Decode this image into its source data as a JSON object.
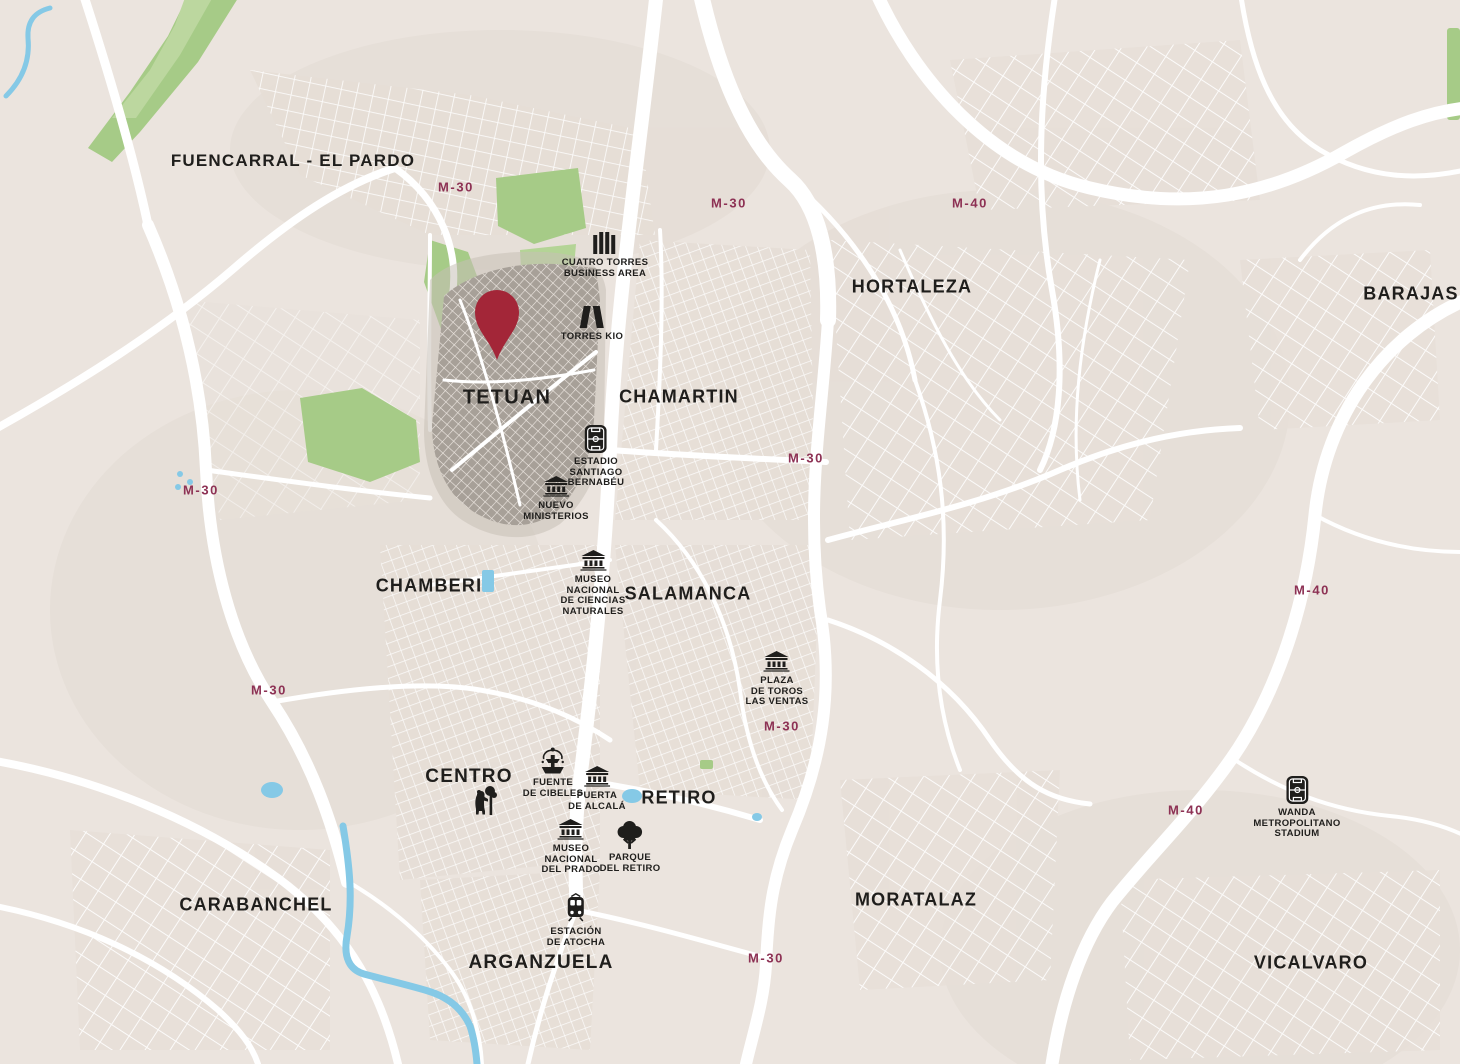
{
  "map": {
    "colors": {
      "background": "#ebe4de",
      "road": "#ffffff",
      "park": "#a6cb87",
      "park_light": "#bcd79f",
      "water": "#85c9e6",
      "district_highlight": "#a7a098",
      "pin": "#a32638",
      "road_label": "#8d3154",
      "label_text": "#1f1e1c"
    },
    "pin": {
      "x": 497,
      "y": 360
    },
    "district_labels": [
      {
        "label": "FUENCARRAL - EL PARDO",
        "x": 293,
        "y": 161,
        "size": 17
      },
      {
        "label": "HORTALEZA",
        "x": 912,
        "y": 287,
        "size": 18
      },
      {
        "label": "BARAJAS",
        "x": 1411,
        "y": 294,
        "size": 18
      },
      {
        "label": "TETUAN",
        "x": 507,
        "y": 398,
        "size": 20
      },
      {
        "label": "CHAMARTIN",
        "x": 679,
        "y": 397,
        "size": 18
      },
      {
        "label": "CHAMBERI",
        "x": 429,
        "y": 586,
        "size": 18
      },
      {
        "label": "SALAMANCA",
        "x": 688,
        "y": 594,
        "size": 18
      },
      {
        "label": "CENTRO",
        "x": 469,
        "y": 777,
        "size": 19
      },
      {
        "label": "RETIRO",
        "x": 679,
        "y": 798,
        "size": 18
      },
      {
        "label": "CARABANCHEL",
        "x": 256,
        "y": 905,
        "size": 18
      },
      {
        "label": "MORATALAZ",
        "x": 916,
        "y": 900,
        "size": 18
      },
      {
        "label": "ARGANZUELA",
        "x": 541,
        "y": 963,
        "size": 19
      },
      {
        "label": "VICALVARO",
        "x": 1311,
        "y": 963,
        "size": 18
      }
    ],
    "road_labels": [
      {
        "label": "M-30",
        "x": 456,
        "y": 187
      },
      {
        "label": "M-30",
        "x": 729,
        "y": 203
      },
      {
        "label": "M-40",
        "x": 970,
        "y": 203
      },
      {
        "label": "M-30",
        "x": 201,
        "y": 490
      },
      {
        "label": "M-30",
        "x": 806,
        "y": 458
      },
      {
        "label": "M-40",
        "x": 1312,
        "y": 590
      },
      {
        "label": "M-30",
        "x": 269,
        "y": 690
      },
      {
        "label": "M-30",
        "x": 782,
        "y": 726
      },
      {
        "label": "M-40",
        "x": 1186,
        "y": 810
      },
      {
        "label": "M-30",
        "x": 766,
        "y": 958
      }
    ],
    "landmarks": [
      {
        "name": "cuatro-torres-business-area",
        "icon": "four-towers-icon",
        "x": 605,
        "y": 232,
        "lines": [
          "CUATRO TORRES",
          "BUSINESS AREA"
        ]
      },
      {
        "name": "torres-kio",
        "icon": "kio-towers-icon",
        "x": 592,
        "y": 306,
        "lines": [
          "TORRES KIO"
        ]
      },
      {
        "name": "estadio-santiago-bernabeu",
        "icon": "stadium-icon",
        "x": 596,
        "y": 425,
        "lines": [
          "ESTADIO",
          "SANTIAGO",
          "BERNABÉU"
        ]
      },
      {
        "name": "nuevo-ministerios",
        "icon": "museum-icon",
        "x": 556,
        "y": 476,
        "lines": [
          "NUEVO",
          "MINISTERIOS"
        ]
      },
      {
        "name": "museo-nacional-de-ciencias-naturales",
        "icon": "museum-icon",
        "x": 593,
        "y": 550,
        "lines": [
          "MUSEO",
          "NACIONAL",
          "DE CIENCIAS",
          "NATURALES"
        ]
      },
      {
        "name": "plaza-de-toros-las-ventas",
        "icon": "museum-icon",
        "x": 777,
        "y": 651,
        "lines": [
          "PLAZA",
          "DE TOROS",
          "LAS VENTAS"
        ]
      },
      {
        "name": "fuente-de-cibeles",
        "icon": "fountain-icon",
        "x": 553,
        "y": 747,
        "lines": [
          "FUENTE",
          "DE CIBELES"
        ]
      },
      {
        "name": "puerta-de-alcala",
        "icon": "museum-icon",
        "x": 597,
        "y": 766,
        "lines": [
          "PUERTA",
          "DE ALCALÁ"
        ]
      },
      {
        "name": "oso-y-madrono",
        "icon": "bear-icon",
        "x": 484,
        "y": 785,
        "lines": []
      },
      {
        "name": "museo-nacional-del-prado",
        "icon": "museum-icon",
        "x": 571,
        "y": 819,
        "lines": [
          "MUSEO",
          "NACIONAL",
          "DEL PRADO"
        ]
      },
      {
        "name": "parque-del-retiro",
        "icon": "tree-icon",
        "x": 630,
        "y": 821,
        "lines": [
          "PARQUE",
          "DEL RETIRO"
        ]
      },
      {
        "name": "estacion-de-atocha",
        "icon": "train-icon",
        "x": 576,
        "y": 893,
        "lines": [
          "ESTACIÓN",
          "DE ATOCHA"
        ]
      },
      {
        "name": "wanda-metropolitano-stadium",
        "icon": "stadium-icon",
        "x": 1297,
        "y": 776,
        "lines": [
          "WANDA",
          "METROPOLITANO",
          "STADIUM"
        ]
      }
    ]
  }
}
